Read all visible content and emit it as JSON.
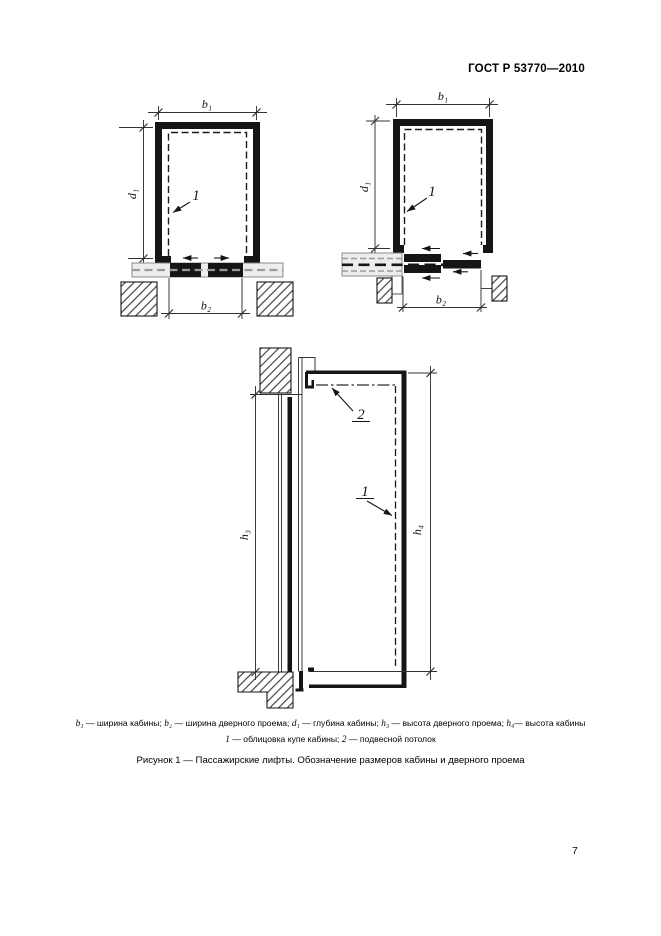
{
  "header": {
    "doc_number": "ГОСТ Р 53770—2010"
  },
  "page_number": "7",
  "figure": {
    "caption": "Рисунок 1 — Пассажирские лифты. Обозначение размеров кабины и дверного проема",
    "legend_line1": [
      {
        "sym": "b₁",
        "desc": " — ширина кабины; "
      },
      {
        "sym": "b₂",
        "desc": " — ширина дверного проема; "
      },
      {
        "sym": "d₁",
        "desc": " — глубина кабины; "
      },
      {
        "sym": "h₃",
        "desc": " — высота дверного проема; "
      },
      {
        "sym": "h₄",
        "desc": "— высота кабины"
      }
    ],
    "legend_line2": [
      {
        "sym": "1",
        "desc": " — облицовка купе кабины; "
      },
      {
        "sym": "2",
        "desc": " — подвесной потолок"
      }
    ]
  },
  "diagram_plan_center": {
    "width_label": "b₁",
    "depth_label": "d₁",
    "door_width_label": "b₂",
    "lining_callout": "1"
  },
  "diagram_plan_side": {
    "width_label": "b₁",
    "depth_label": "d₁",
    "door_width_label": "b₂",
    "lining_callout": "1"
  },
  "diagram_section": {
    "door_height_label": "h₃",
    "cab_height_label": "h₄",
    "lining_callout": "1",
    "ceiling_callout": "2"
  },
  "colors": {
    "ink": "#151515",
    "band_fill": "#ededed",
    "band_dash": "#9a9a9a"
  }
}
